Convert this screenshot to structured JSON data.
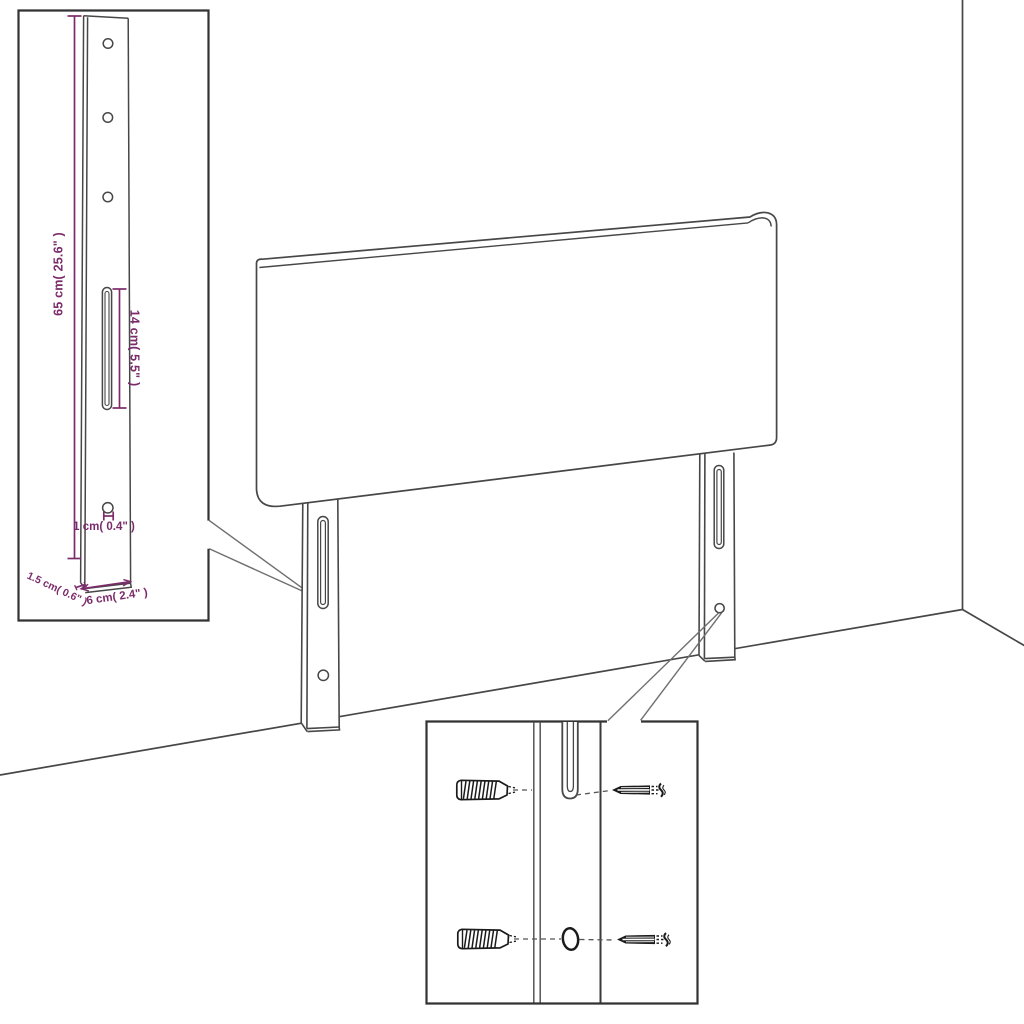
{
  "colors": {
    "background": "#ffffff",
    "line": "#474747",
    "box_border": "#333333",
    "dimension": "#7b2b6b",
    "hardware": "#1b1b1b",
    "callout": "#6f6f6f"
  },
  "bracket_inset": {
    "dim_height": "65 cm( 25.6\" )",
    "dim_slot": "14 cm( 5.5\" )",
    "dim_hole": "1 cm( 0.4\" )",
    "dim_width": "6 cm( 2.4\" )",
    "dim_thickness": "1.5 cm( 0.6\" )",
    "hole_count": 4,
    "slot_count": 1
  },
  "headboard": {
    "leg_count": 2,
    "slots_per_leg": 1,
    "holes_per_leg": 1
  },
  "hardware_inset": {
    "wall_plug_count": 2,
    "screw_count": 2,
    "hole_count": 1,
    "slot_count": 1
  }
}
